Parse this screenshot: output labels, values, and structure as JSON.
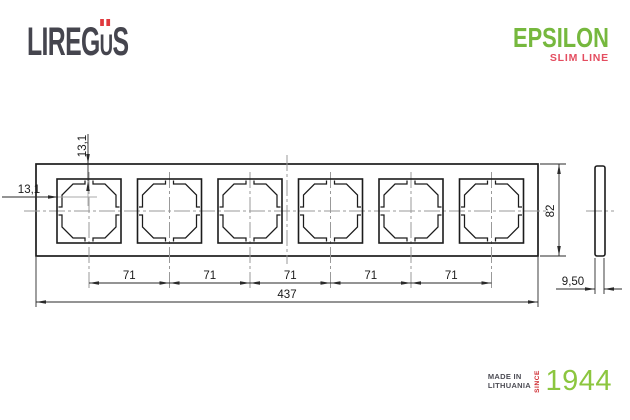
{
  "header": {
    "brand": {
      "part1": "LIREG",
      "part2": "U",
      "part3": "S"
    },
    "epsilon": "EPSILON",
    "slim_line": "SLIM LINE"
  },
  "drawing": {
    "dim_offset_left": "13,1",
    "dim_offset_top": "13,1",
    "dim_pitch": [
      "71",
      "71",
      "71",
      "71",
      "71"
    ],
    "dim_total_width": "437",
    "dim_height": "82",
    "dim_depth": "9,50"
  },
  "footer": {
    "made_in_line1": "MADE IN",
    "made_in_line2": "LITHUANIA",
    "since": "SINCE",
    "year": "1944"
  },
  "colors": {
    "brand_text": "#45454e",
    "brand_umlaut_dots": "#e03a3e",
    "epsilon_green": "#76b83e",
    "slim_line_red": "#e44d60",
    "since_red": "#cf2a30",
    "year_green": "#8cc63f",
    "outline_black": "#1c1c1c",
    "centerline_gray": "#999999"
  }
}
